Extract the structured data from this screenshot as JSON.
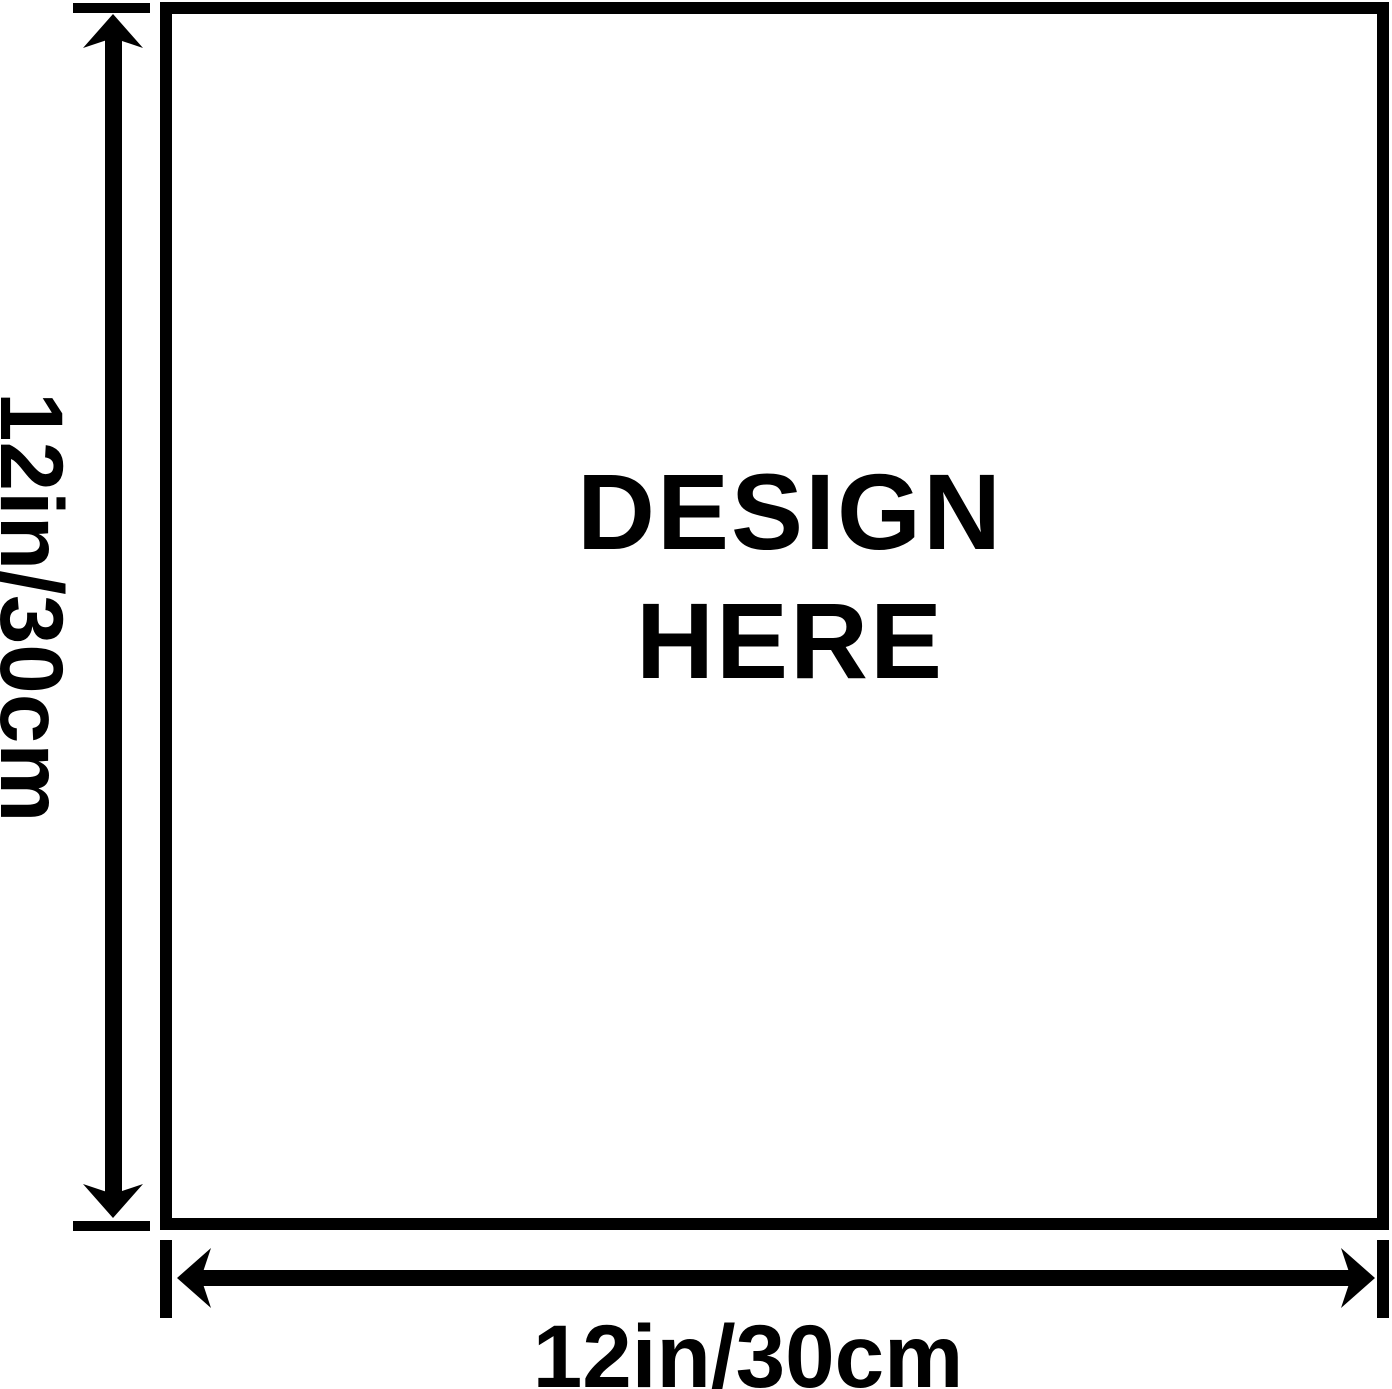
{
  "design_area": {
    "line1": "DESIGN",
    "line2": "HERE"
  },
  "dimensions": {
    "height_label": "12in/30cm",
    "width_label": "12in/30cm"
  },
  "icons": {
    "height_arrow": "double-headed-vertical-arrow",
    "width_arrow": "double-headed-horizontal-arrow"
  },
  "colors": {
    "ink": "#000000",
    "background": "#ffffff"
  }
}
